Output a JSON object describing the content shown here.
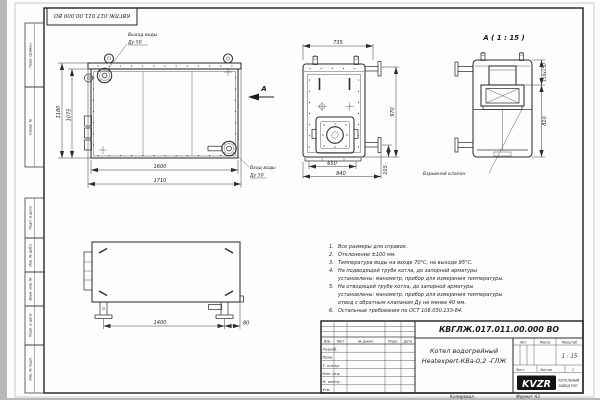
{
  "sheet": {
    "doc_number": "КВГЛЖ.017.011.00.000 ВО",
    "copied": "Копировал",
    "format": "Формат А3"
  },
  "margin_stamps": {
    "perv_primen": "Перв. примен.",
    "sprav_no": "Справ. №",
    "podp_data_1": "Подп. и дата",
    "inv_dubl": "Инв. № дубл.",
    "vzam_inv": "Взам. инв. №",
    "podp_data_2": "Подп. и дата",
    "inv_podl": "Инв. № подл."
  },
  "front_view": {
    "outlet_label": "Выход воды",
    "outlet_dn": "Ду 50",
    "inlet_label": "Вход воды",
    "inlet_dn": "Ду 50",
    "dim_h_outer": "1180",
    "dim_h_inner": "1075",
    "dim_w_inner": "1600",
    "dim_w_outer": "1710",
    "view_arrow": "А"
  },
  "side_view": {
    "dim_top": "735",
    "dim_bottom_inner": "650",
    "dim_bottom_outer": "840",
    "dim_right": "970",
    "dim_flange": "105"
  },
  "detail_view": {
    "title": "А ( 1 : 15 )",
    "dim_collar": "150x250",
    "dim_height": "810",
    "valve_label": "Взрывной клапан"
  },
  "bottom_view": {
    "dim_span": "1400",
    "dim_offset": "80"
  },
  "notes": [
    {
      "num": "1.",
      "text": "Все размеры для справок."
    },
    {
      "num": "2.",
      "text": "Отклонение ±100 мм."
    },
    {
      "num": "3.",
      "text": "Температура воды на входе 70°С, на выходе 95°С."
    },
    {
      "num": "4.",
      "text": "На подводящей трубе котла, до запорной арматуры установлены: манометр, прибор для измерения температуры."
    },
    {
      "num": "5.",
      "text": "На отводящей трубе котла, до запорной арматуры установлены: манометр, прибор для измерения температуры  отвод с обратным клапаном Ду не менее 40 мм."
    },
    {
      "num": "6.",
      "text": "Остальные требования по ОСТ 108.030.133-84."
    }
  ],
  "title_block": {
    "doc_number": "КВГЛЖ.017.011.00.000 ВО",
    "product_line1": "Котел водогрейный",
    "product_line2": "Heatexpert-КВа-0,2 -ГЛЖ",
    "col_izm": "Изм.",
    "col_list": "Лист",
    "col_doc": "№ докум.",
    "col_podp": "Подп.",
    "col_data": "Дата",
    "row_razrab": "Разраб.",
    "row_prov": "Пров.",
    "row_tkontr": "Т. контр.",
    "row_nachotd": "Нач. отд.",
    "row_nkontr": "Н. контр.",
    "row_utv": "Утв.",
    "lit": "Лит.",
    "massa": "Масса",
    "masshtab": "Масштаб",
    "scale_value": "1 : 15",
    "list": "Лист",
    "listov": "Листов",
    "listov_value": "1",
    "logo": "KVZR",
    "company1": "КОТЕЛЬНЫЙ",
    "company2": "ЗАВОД РЭП"
  }
}
